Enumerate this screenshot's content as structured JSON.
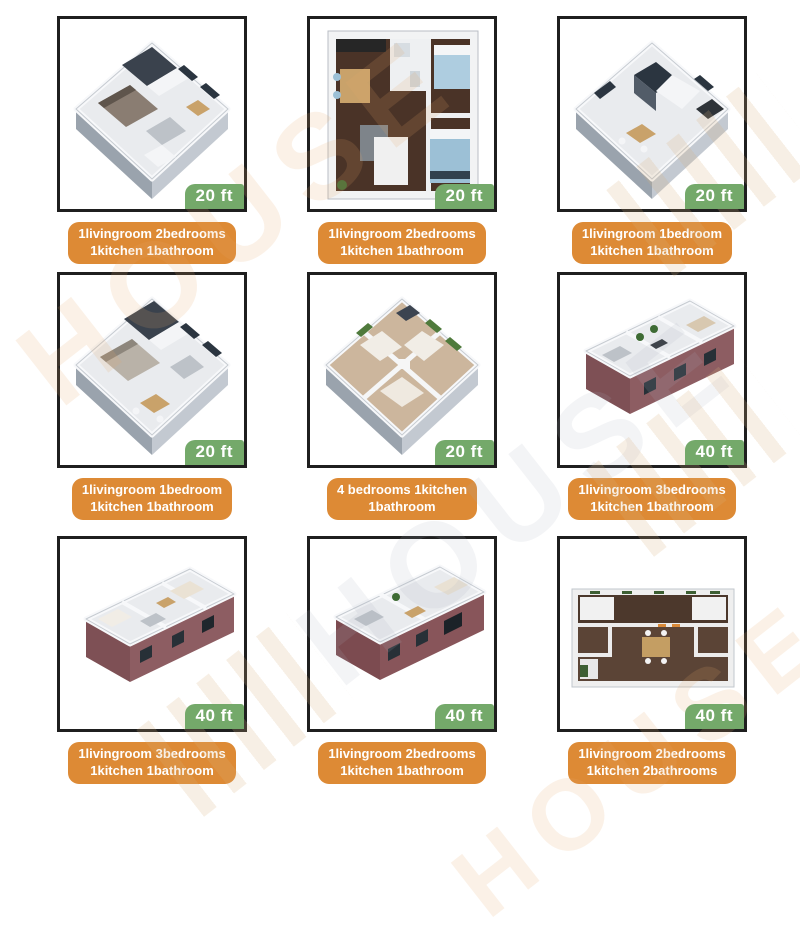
{
  "colors": {
    "badge_green": "#74a96a",
    "caption_orange": "#dd8a35",
    "box_border": "#1f1f1f",
    "background": "#ffffff"
  },
  "watermark": {
    "text": "HOUSE"
  },
  "cells": [
    {
      "badge": "20 ft",
      "caption_line1": "1livingroom 2bedrooms",
      "caption_line2": "1kitchen 1bathroom"
    },
    {
      "badge": "20 ft",
      "caption_line1": "1livingroom 2bedrooms",
      "caption_line2": "1kitchen 1bathroom"
    },
    {
      "badge": "20 ft",
      "caption_line1": "1livingroom 1bedroom",
      "caption_line2": "1kitchen 1bathroom"
    },
    {
      "badge": "20 ft",
      "caption_line1": "1livingroom 1bedroom",
      "caption_line2": "1kitchen 1bathroom"
    },
    {
      "badge": "20 ft",
      "caption_line1": "4 bedrooms 1kitchen",
      "caption_line2": "1bathroom"
    },
    {
      "badge": "40 ft",
      "caption_line1": "1livingroom 3bedrooms",
      "caption_line2": "1kitchen 1bathroom"
    },
    {
      "badge": "40 ft",
      "caption_line1": "1livingroom 3bedrooms",
      "caption_line2": "1kitchen 1bathroom"
    },
    {
      "badge": "40 ft",
      "caption_line1": "1livingroom 2bedrooms",
      "caption_line2": "1kitchen 1bathroom"
    },
    {
      "badge": "40 ft",
      "caption_line1": "1livingroom 2bedrooms",
      "caption_line2": "1kitchen 2bathrooms"
    }
  ]
}
